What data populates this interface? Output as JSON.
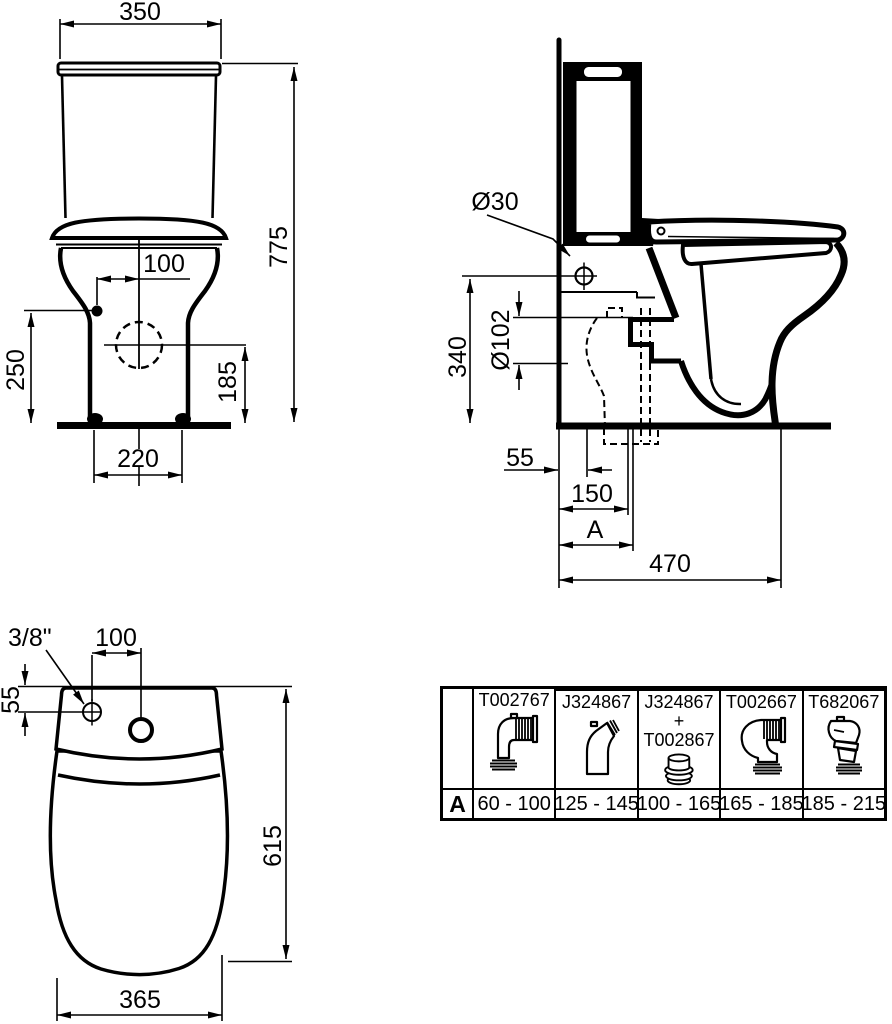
{
  "drawing": {
    "ink_color": "#000000",
    "paper_color": "#ffffff"
  },
  "front_view": {
    "dims": {
      "tank_width": "350",
      "total_height": "775",
      "supply_offset_x": "100",
      "supply_height": "250",
      "outlet_height": "185",
      "base_width": "220"
    }
  },
  "side_view": {
    "dims": {
      "inlet_hole_diameter": "Ø30",
      "outlet_diameter": "Ø102",
      "inlet_height": "340",
      "supply_from_wall": "55",
      "outlet_from_wall": "150",
      "adjustable_distance": "A",
      "depth_from_wall": "470"
    }
  },
  "plan_view": {
    "dims": {
      "supply_thread": "3/8\"",
      "supply_offset_x": "100",
      "supply_offset_y": "55",
      "total_depth": "615",
      "bowl_width": "365"
    }
  },
  "table": {
    "row_label": "A",
    "columns": [
      {
        "part_line1": "T002767",
        "part_line2": "",
        "part_line3": "",
        "icon": "elbow-horizontal-outlet-icon",
        "range": "60 - 100"
      },
      {
        "part_line1": "J324867",
        "part_line2": "",
        "part_line3": "",
        "icon": "offset-vertical-outlet-icon",
        "range": "125 - 145"
      },
      {
        "part_line1": "J324867",
        "part_line2": "+",
        "part_line3": "T002867",
        "icon": "adapter-seal-ring-icon",
        "range": "100 - 165"
      },
      {
        "part_line1": "T002667",
        "part_line2": "",
        "part_line3": "",
        "icon": "elbow-corrugated-outlet-icon",
        "range": "165 - 185"
      },
      {
        "part_line1": "T682067",
        "part_line2": "",
        "part_line3": "",
        "icon": "angled-outlet-icon",
        "range": "185 - 215"
      }
    ]
  }
}
